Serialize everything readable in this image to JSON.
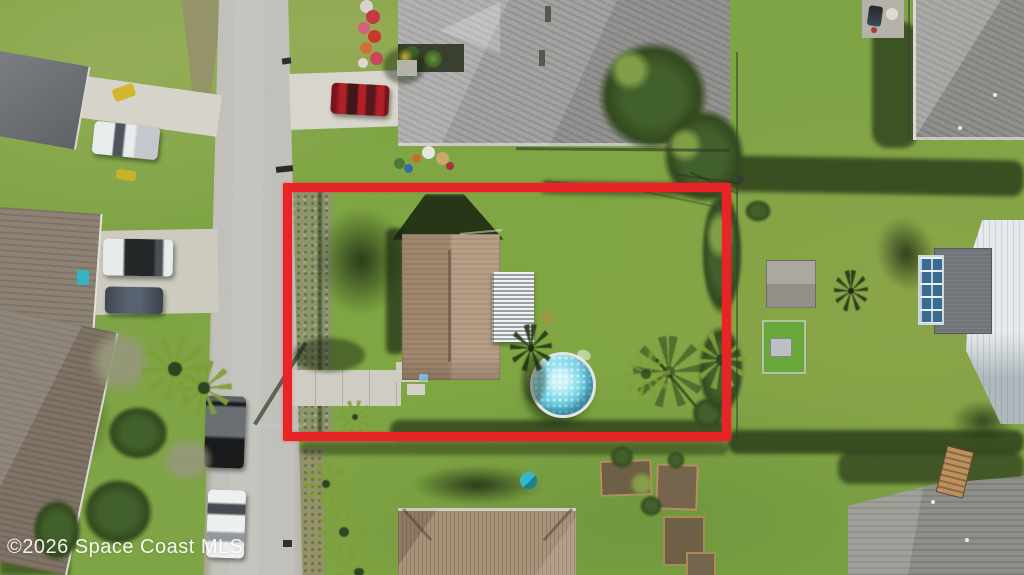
{
  "watermark": {
    "text": "©2026 Space Coast MLS",
    "position": "bottom-left"
  },
  "boundary_annotation": {
    "shape": "rectangle",
    "purpose": "highlighted property lot",
    "x": 283,
    "y": 183,
    "width": 448,
    "height": 258,
    "stroke_px": 9
  },
  "colors": {
    "boundary-red": "#ea2327",
    "grass-base": "#7fa445",
    "road-gray": "#c1c0bb",
    "driveway-concrete": "#d5d3ca",
    "subject-roof-tan": "#ae9379",
    "lanai-metal-light": "#eff1f0",
    "lanai-metal-dark": "#99a0a6",
    "pool-water": "#5fc9e0",
    "pool-rim": "#dfe6e3",
    "neighbor-roof-gray": "#a2a2a0",
    "metal-roof-white": "#e7eaec",
    "tree-dark-green": "#33491f",
    "shadow-green": "#22340f",
    "red-car": "#b22026",
    "watermark-white": "rgba(255,255,255,0.92)"
  },
  "scene": {
    "description": "Aerial drone photo of a suburban neighborhood; a red rectangle outlines a single-family lot containing a tan gable-roof house, corrugated metal lanai, round above-ground pool, concrete driveway, palms and lawn.",
    "subject_lot_features": [
      "tan shingle roof house",
      "corrugated metal lanai roof",
      "round above-ground pool",
      "concrete driveway",
      "palm tree",
      "weedy side strip",
      "tree line on right boundary"
    ],
    "surroundings": [
      "residential street on left",
      "gray-roof neighbor house at top with red car",
      "top-right corner house with patio grill",
      "right neighbor with white metal roof, blue pool cage, shed and dog pen",
      "bottom house with tan hip roof and raised garden beds",
      "bottom-right gray roof house with wooden footbridge",
      "parked vehicles: white pickup, white SUV, gray sedan, black pickup, white car"
    ]
  }
}
